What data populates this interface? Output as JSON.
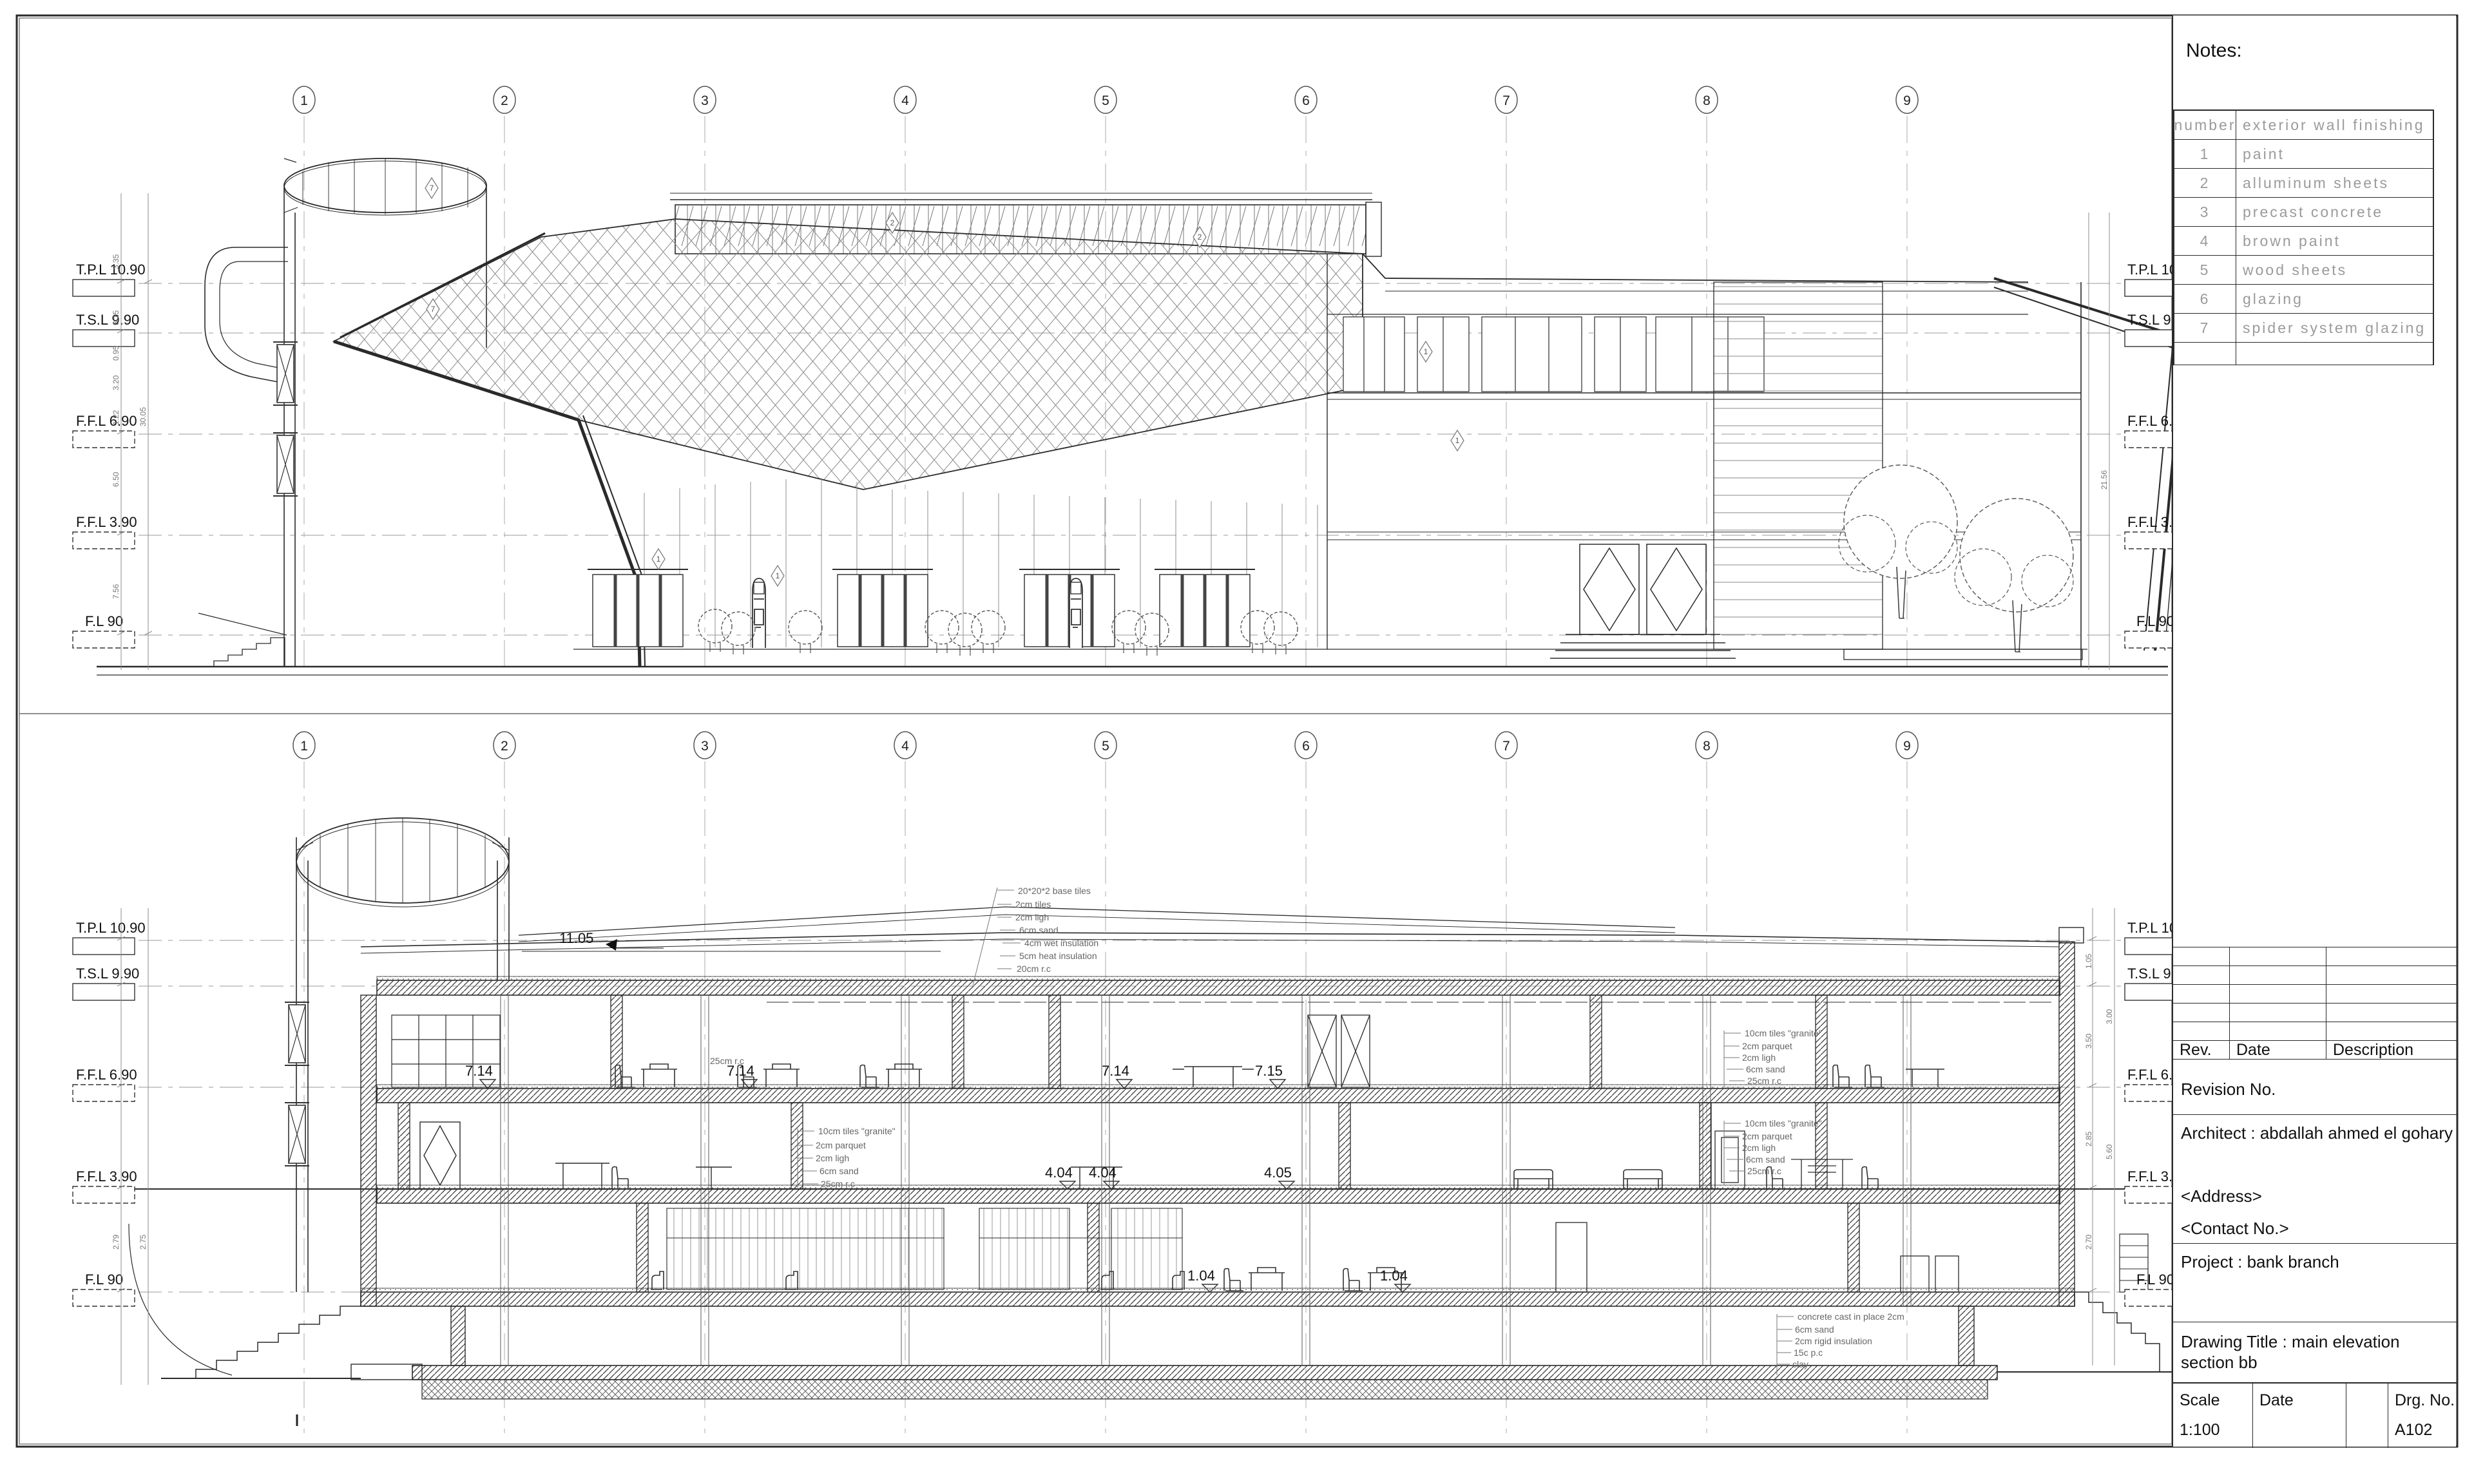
{
  "sheet": {
    "bg": "#ffffff",
    "ink": "#222222",
    "cad_gray": "#9b9b9b"
  },
  "notes": {
    "title": "Notes:",
    "headers": [
      "number",
      "exterior wall finishing"
    ],
    "rows": [
      [
        "1",
        "paint"
      ],
      [
        "2",
        "alluminum sheets"
      ],
      [
        "3",
        "precast concrete"
      ],
      [
        "4",
        "brown paint"
      ],
      [
        "5",
        "wood sheets"
      ],
      [
        "6",
        "glazing"
      ],
      [
        "7",
        "spider system glazing"
      ]
    ]
  },
  "grid_labels": [
    "1",
    "2",
    "3",
    "4",
    "5",
    "6",
    "7",
    "8",
    "9"
  ],
  "levels": [
    "T.P.L 10.90",
    "T.S.L 9.90",
    "F.F.L 6.90",
    "F.F.L 3.90",
    "F.L 90"
  ],
  "elevation": {
    "keynotes": [
      "7",
      "7",
      "2",
      "2",
      "1",
      "1",
      "1",
      "1"
    ],
    "dims": {
      "segments": [
        "3.35",
        "3.15",
        "0.95",
        "3.20",
        "1.22",
        "6.50",
        "7.56"
      ],
      "totals": [
        "30.05",
        "21.56"
      ]
    }
  },
  "section": {
    "spots": [
      "11.05",
      "7.14",
      "7.14",
      "7.14",
      "7.15",
      "4.04",
      "4.04",
      "4.05",
      "1.04",
      "1.04"
    ],
    "callouts": {
      "roof": [
        "20*20*2 base tiles",
        "2cm tiles",
        "2cm ligh",
        "6cm sand",
        "4cm wet insulation",
        "5cm heat insulation",
        "20cm r.c"
      ],
      "floor": [
        "10cm tiles \"granite\"",
        "2cm parquet",
        "2cm ligh",
        "6cm sand",
        "25cm r.c"
      ],
      "slab_note": "25cm r.c",
      "basement": [
        "concrete cast in place 2cm",
        "6cm sand",
        "2cm rigid insulation",
        "15c p.c",
        "clay"
      ]
    },
    "dims": [
      "1.05",
      "3.50",
      "2.85",
      "2.70",
      "3.00",
      "5.60",
      "2.79",
      "2.75"
    ]
  },
  "titleblock": {
    "rev": "Rev.",
    "date": "Date",
    "description": "Description",
    "revision_no": "Revision No.",
    "architect": "Architect : abdallah ahmed el gohary",
    "address": "<Address>",
    "contact": "<Contact No.>",
    "project": "Project : bank branch",
    "drawing_title_1": "Drawing Title : main elevation",
    "drawing_title_2": "section bb",
    "scale_label": "Scale",
    "scale_value": "1:100",
    "date_label": "Date",
    "drg_label": "Drg. No.",
    "drg_value": "A102"
  }
}
